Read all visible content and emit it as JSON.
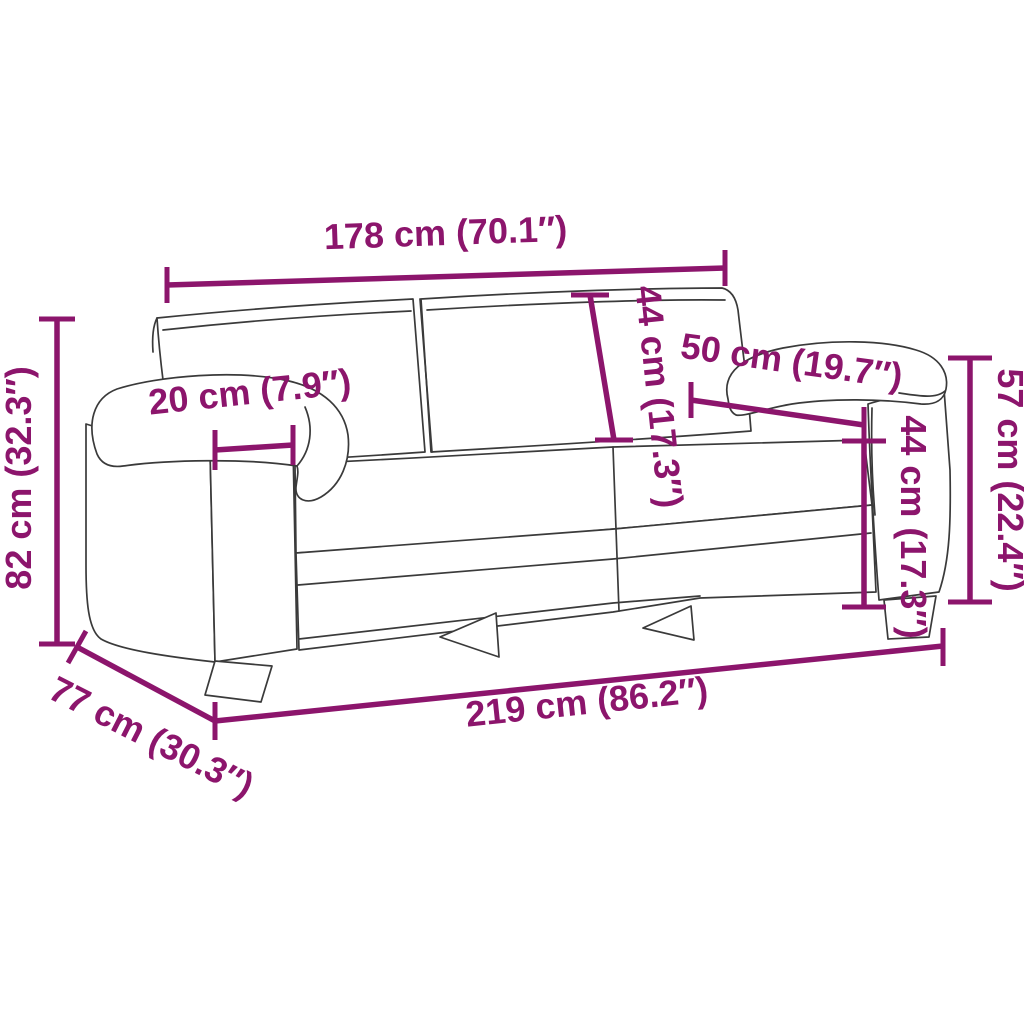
{
  "diagram": {
    "subject": "sofa-dimension-diagram",
    "background_color": "#ffffff",
    "outline_color": "#3a3a3a",
    "accent_color": "#8C156C"
  },
  "dimensions": {
    "back_width": {
      "label": "178 cm (70.1″)",
      "value_cm": 178,
      "value_in": "70.1"
    },
    "overall_height": {
      "label": "82 cm (32.3″)",
      "value_cm": 82,
      "value_in": "32.3"
    },
    "armrest_width": {
      "label": "20 cm (7.9″)",
      "value_cm": 20,
      "value_in": "7.9"
    },
    "backrest_height": {
      "label": "44 cm (17.3″)",
      "value_cm": 44,
      "value_in": "17.3"
    },
    "armrest_depth": {
      "label": "50 cm (19.7″)",
      "value_cm": 50,
      "value_in": "19.7"
    },
    "armrest_height": {
      "label": "44 cm (17.3″)",
      "value_cm": 44,
      "value_in": "17.3"
    },
    "side_height": {
      "label": "57 cm (22.4″)",
      "value_cm": 57,
      "value_in": "22.4"
    },
    "overall_width": {
      "label": "219 cm (86.2″)",
      "value_cm": 219,
      "value_in": "86.2"
    },
    "overall_depth": {
      "label": "77 cm (30.3″)",
      "value_cm": 77,
      "value_in": "30.3"
    }
  }
}
